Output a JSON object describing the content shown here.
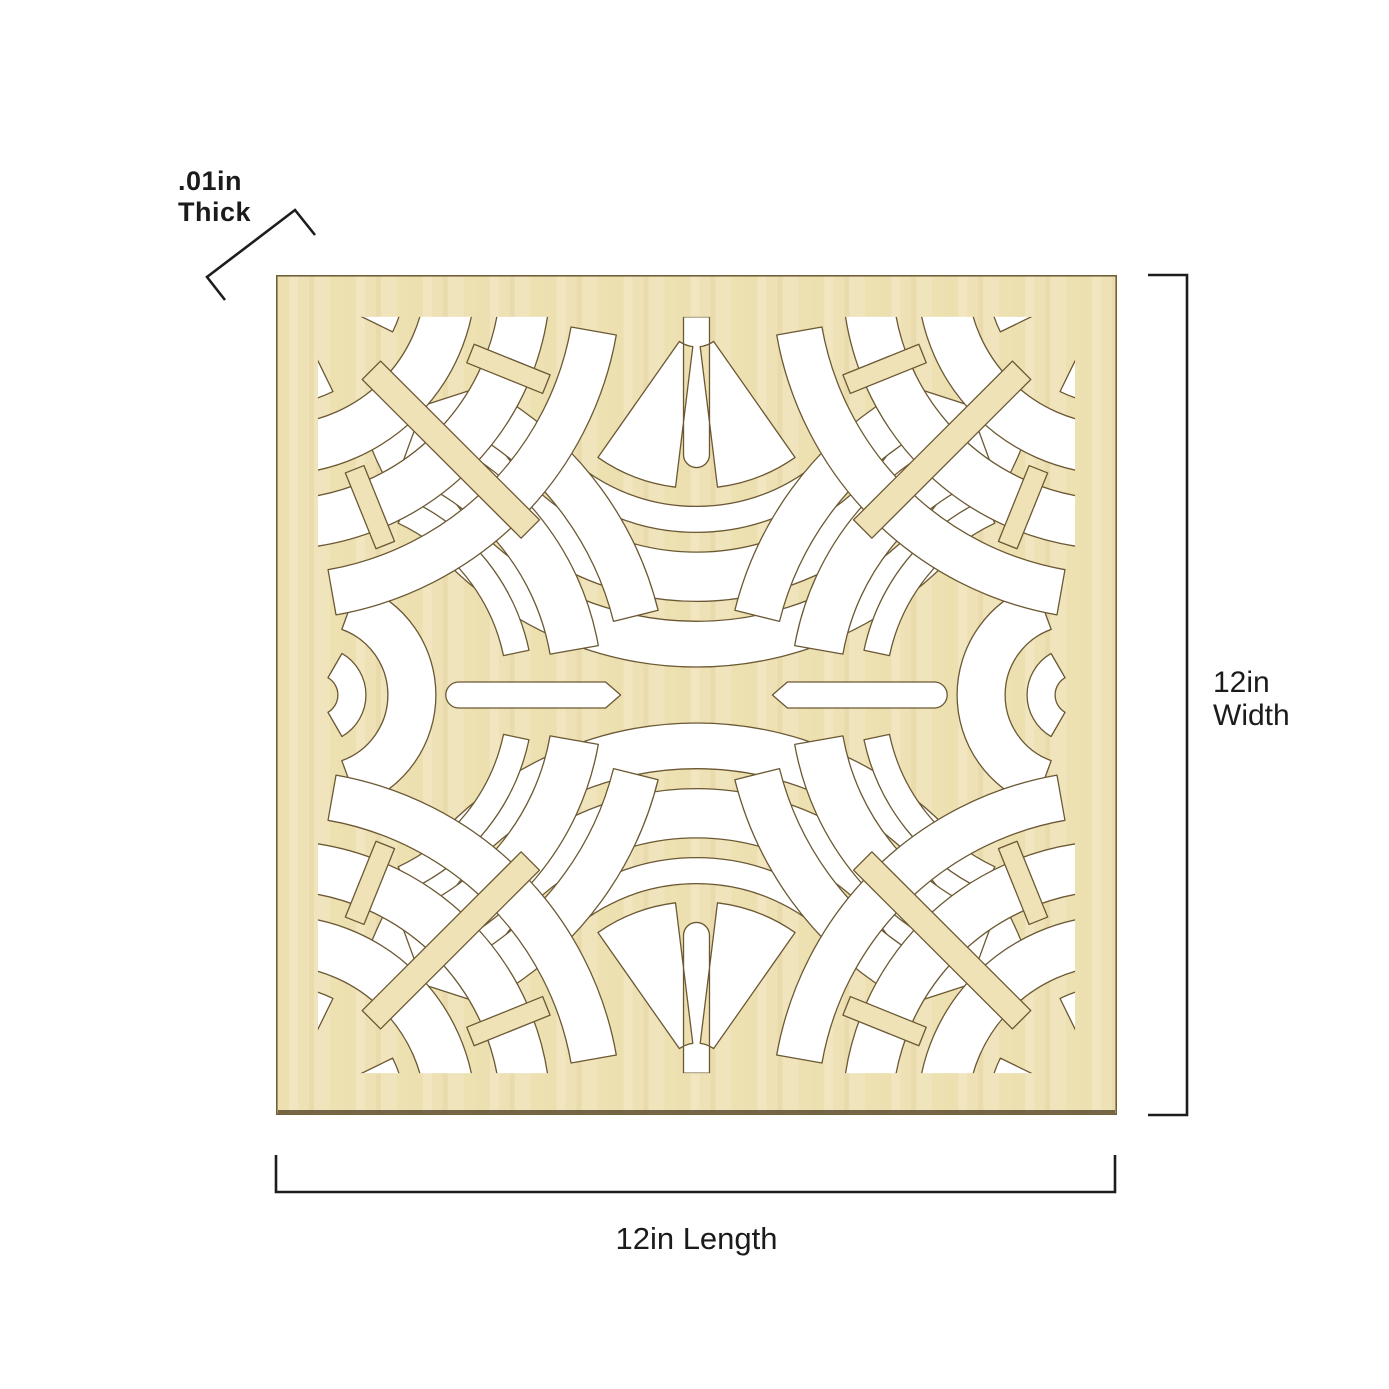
{
  "page": {
    "background_color": "#ffffff"
  },
  "panel": {
    "material_color": "#efe2b6",
    "grain_dark_color": "#e7d9a5",
    "grain_light_color": "#f5ebcb",
    "cut_edge_color": "#6b5833",
    "cutout_color": "#ffffff"
  },
  "dimensions": {
    "thickness": {
      "value": ".01in",
      "label": "Thick"
    },
    "width": {
      "value": "12in",
      "label": "Width"
    },
    "length": {
      "label": "12in Length"
    }
  },
  "dimension_line_color": "#1d1d1d",
  "text_color": "#1b1b1b"
}
